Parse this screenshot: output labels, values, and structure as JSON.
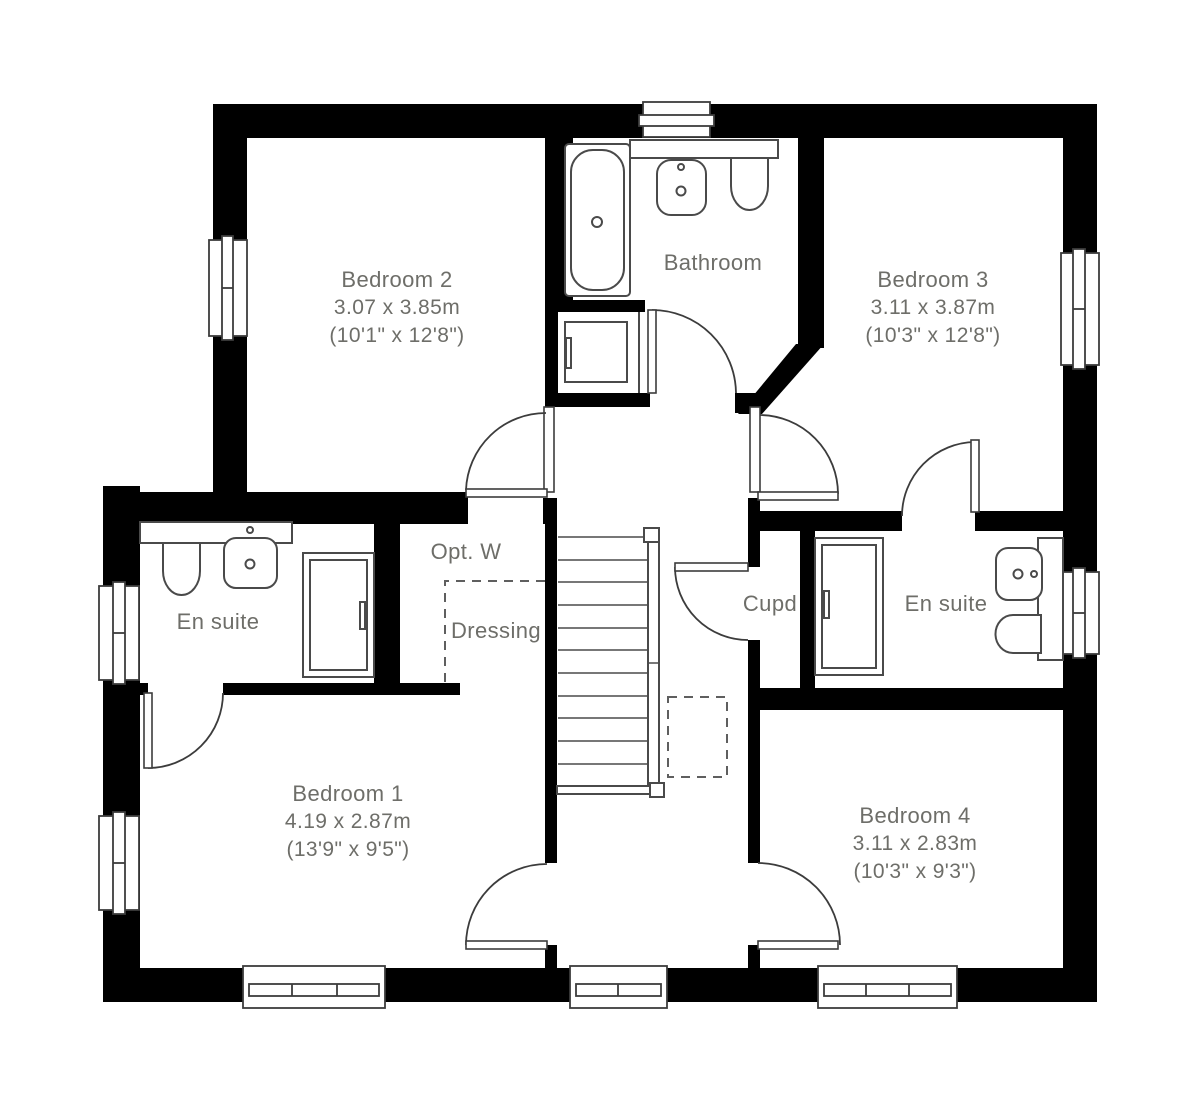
{
  "plan_type": "floor-plan",
  "colors": {
    "wall": "#000000",
    "fixture_line": "#4a4a4a",
    "label_text": "#6e6e69",
    "background": "#ffffff"
  },
  "rooms": {
    "bedroom2": {
      "name": "Bedroom 2",
      "metric": "3.07 x 3.85m",
      "imperial": "(10'1\" x 12'8\")"
    },
    "bathroom": {
      "name": "Bathroom"
    },
    "bedroom3": {
      "name": "Bedroom 3",
      "metric": "3.11 x 3.87m",
      "imperial": "(10'3\" x 12'8\")"
    },
    "ensuite_left": {
      "name": "En suite"
    },
    "opt_w": {
      "name": "Opt. W"
    },
    "dressing": {
      "name": "Dressing"
    },
    "cupd": {
      "name": "Cupd"
    },
    "ensuite_right": {
      "name": "En suite"
    },
    "bedroom1": {
      "name": "Bedroom 1",
      "metric": "4.19 x 2.87m",
      "imperial": "(13'9\" x 9'5\")"
    },
    "bedroom4": {
      "name": "Bedroom 4",
      "metric": "3.11 x 2.83m",
      "imperial": "(10'3\" x 9'3\")"
    }
  }
}
